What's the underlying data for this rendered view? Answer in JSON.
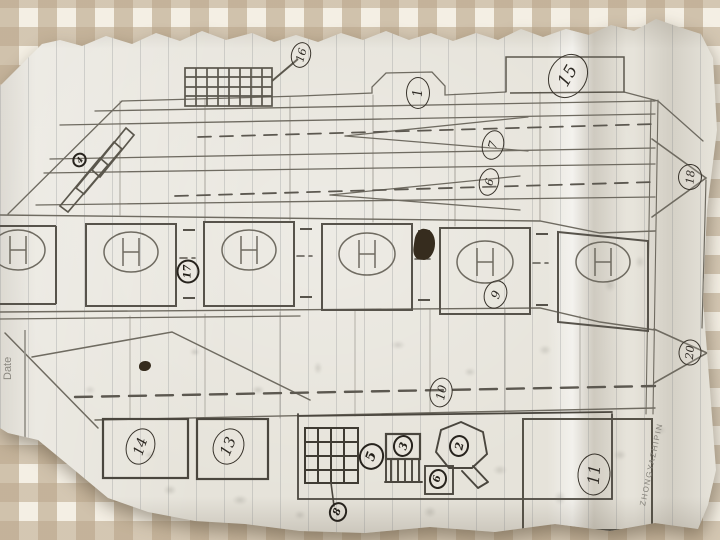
{
  "scene": {
    "kind": "photograph of a hand-drawn pencil papercraft plan lying on gingham fabric",
    "fabric_check_color": "#baa68a",
    "fabric_base_color": "#f4efe4",
    "paper_color": "#e6e3da",
    "pencil_color": "#6f6b61",
    "ink_color": "#2e2a24"
  },
  "paper": {
    "printed": {
      "no_label": "No.",
      "date_label": "Date",
      "brand": "ZHONGYAZHIPIN"
    }
  },
  "diagram": {
    "part_labels": [
      {
        "id": "16",
        "value": "16"
      },
      {
        "id": "1",
        "value": "1"
      },
      {
        "id": "15",
        "value": "15"
      },
      {
        "id": "7",
        "value": "7"
      },
      {
        "id": "6-upper",
        "value": "6"
      },
      {
        "id": "18",
        "value": "18"
      },
      {
        "id": "4",
        "value": "4"
      },
      {
        "id": "17",
        "value": "17"
      },
      {
        "id": "9",
        "value": "9"
      },
      {
        "id": "10",
        "value": "10"
      },
      {
        "id": "20",
        "value": "20"
      },
      {
        "id": "14",
        "value": "14"
      },
      {
        "id": "13",
        "value": "13"
      },
      {
        "id": "5",
        "value": "5"
      },
      {
        "id": "8",
        "value": "8"
      },
      {
        "id": "3",
        "value": "3"
      },
      {
        "id": "2",
        "value": "2"
      },
      {
        "id": "6-box",
        "value": "6"
      },
      {
        "id": "11",
        "value": "11"
      }
    ]
  }
}
